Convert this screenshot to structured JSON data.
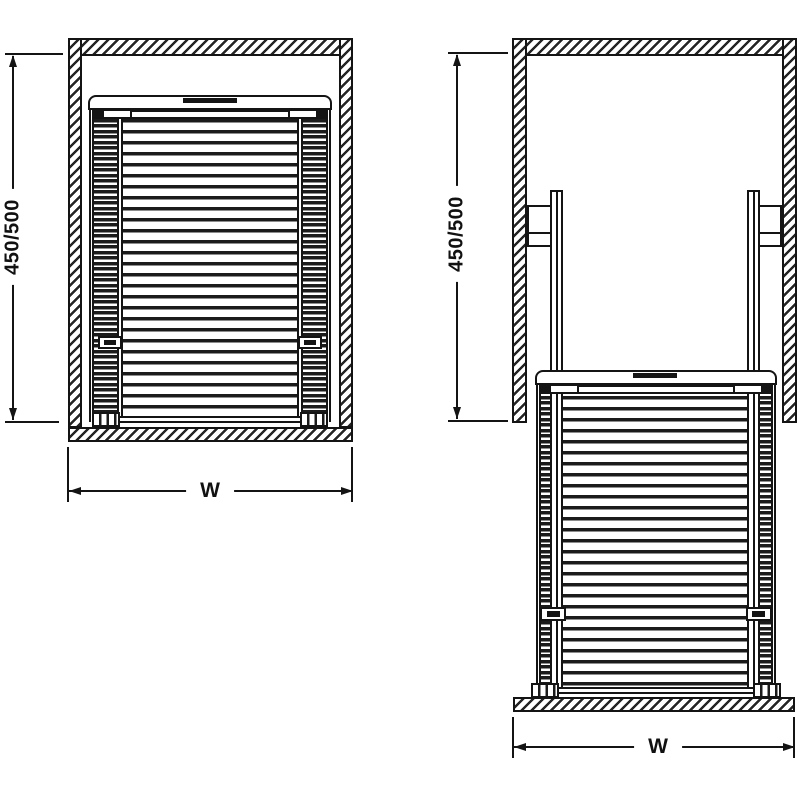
{
  "views": {
    "closed": {
      "height_label": "450/500",
      "width_label": "W"
    },
    "open": {
      "height_label": "450/500",
      "width_label": "W"
    }
  },
  "colors": {
    "line": "#141414",
    "background": "#ffffff"
  }
}
